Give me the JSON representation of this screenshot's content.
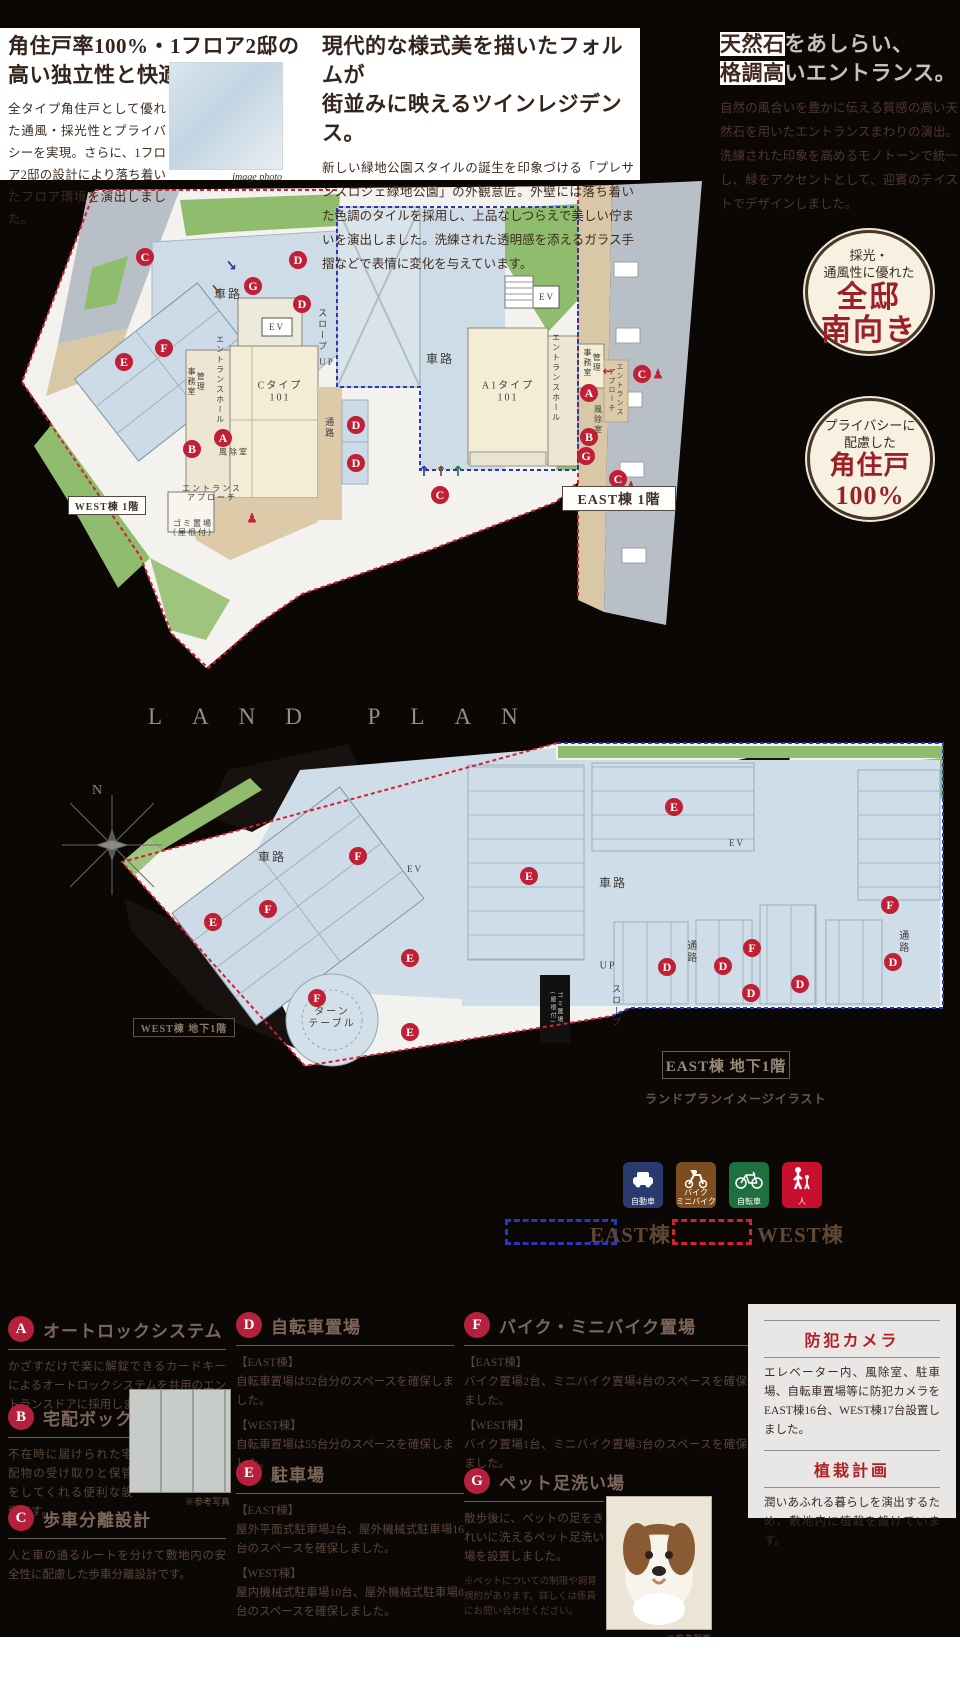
{
  "header": {
    "col1": {
      "title_lines": [
        "角住戸率100%・1フロア2邸の",
        "高い独立性と快適性。"
      ],
      "body": "全タイプ角住戸として優れた通風・採光性とプライバシーを実現。さらに、1フロア2邸の設計により落ち着いたフロア環境を演出しました。",
      "photo_caption": "image photo"
    },
    "col2": {
      "title_lines": [
        "現代的な様式美を描いたフォルムが",
        "街並みに映えるツインレジデンス。"
      ],
      "body": "新しい緑地公園スタイルの誕生を印象づける「プレサンスロジェ緑地公園」の外観意匠。外壁には落ち着いた色調のタイルを採用し、上品なしつらえで美しい佇まいを演出しました。洗練された透明感を添えるガラス手摺などで表情に変化を与えています。"
    },
    "col3": {
      "title1_dark": "天然石",
      "title1_light": "をあしらい、",
      "title2_dark": "格調高",
      "title2_light": "いエントランス。",
      "body": "自然の風合いを豊かに伝える質感の高い天然石を用いたエントランスまわりの演出。洗練された印象を高めるモノトーンで統一し、緑をアクセントとして、迎賓のテイストでデザインしました。"
    }
  },
  "badges": [
    {
      "small1": "採光・",
      "small2": "通風性に優れた",
      "big1": "全邸",
      "big2": "南向き"
    },
    {
      "small1": "プライバシーに",
      "small2": "配慮した",
      "big1": "角住戸",
      "big2": "100%"
    }
  ],
  "land_plan_title": "LAND PLAN",
  "plan1": {
    "labels": [
      {
        "t": "車路",
        "x": 228,
        "y": 295,
        "s": 12
      },
      {
        "t": "車路",
        "x": 440,
        "y": 360,
        "s": 12
      },
      {
        "t": "スロープ",
        "x": 322,
        "y": 330,
        "s": 9,
        "v": true
      },
      {
        "t": "UP",
        "x": 327,
        "y": 362,
        "s": 9
      },
      {
        "t": "EV",
        "x": 277,
        "y": 327,
        "s": 9
      },
      {
        "t": "エントランスホール",
        "x": 220,
        "y": 380,
        "s": 8,
        "v": true
      },
      {
        "t": "管理\n事務室",
        "x": 196,
        "y": 382,
        "s": 8,
        "v": true
      },
      {
        "t": "Cタイプ\n101",
        "x": 280,
        "y": 392,
        "s": 10
      },
      {
        "t": "風除室",
        "x": 234,
        "y": 452,
        "s": 8
      },
      {
        "t": "エントランス\nアプローチ",
        "x": 212,
        "y": 493,
        "s": 8
      },
      {
        "t": "ゴミ置場\n（屋根付）",
        "x": 193,
        "y": 528,
        "s": 8
      },
      {
        "t": "通路",
        "x": 329,
        "y": 428,
        "s": 9,
        "v": true
      },
      {
        "t": "A1タイプ\n101",
        "x": 508,
        "y": 392,
        "s": 10
      },
      {
        "t": "エントランスホール",
        "x": 556,
        "y": 378,
        "s": 8,
        "v": true
      },
      {
        "t": "管理\n事務室",
        "x": 592,
        "y": 363,
        "s": 8,
        "v": true
      },
      {
        "t": "風除室",
        "x": 598,
        "y": 420,
        "s": 8,
        "v": true
      },
      {
        "t": "エントランス\nアプローチ",
        "x": 616,
        "y": 390,
        "s": 7,
        "v": true
      },
      {
        "t": "EV",
        "x": 547,
        "y": 297,
        "s": 9
      }
    ],
    "markers": [
      {
        "l": "C",
        "x": 145,
        "y": 257
      },
      {
        "l": "D",
        "x": 298,
        "y": 260
      },
      {
        "l": "G",
        "x": 253,
        "y": 286
      },
      {
        "l": "D",
        "x": 302,
        "y": 304
      },
      {
        "l": "F",
        "x": 164,
        "y": 348
      },
      {
        "l": "E",
        "x": 124,
        "y": 362
      },
      {
        "l": "A",
        "x": 223,
        "y": 438
      },
      {
        "l": "B",
        "x": 192,
        "y": 449
      },
      {
        "l": "D",
        "x": 356,
        "y": 425
      },
      {
        "l": "D",
        "x": 356,
        "y": 463
      },
      {
        "l": "A",
        "x": 589,
        "y": 393
      },
      {
        "l": "B",
        "x": 589,
        "y": 437
      },
      {
        "l": "G",
        "x": 586,
        "y": 456
      },
      {
        "l": "C",
        "x": 642,
        "y": 374
      },
      {
        "l": "C",
        "x": 618,
        "y": 479
      },
      {
        "l": "C",
        "x": 440,
        "y": 495
      }
    ],
    "glyphs": [
      {
        "ch": "↓",
        "color": "#2a3a9a",
        "x": 232,
        "y": 266,
        "rot": -40,
        "s": 14
      },
      {
        "ch": "↓",
        "color": "#7a4a1a",
        "x": 217,
        "y": 290,
        "rot": -40,
        "s": 14
      },
      {
        "ch": "↑",
        "color": "#2a3a9a",
        "x": 424,
        "y": 472,
        "rot": 0,
        "s": 14
      },
      {
        "ch": "↑",
        "color": "#7a4a1a",
        "x": 441,
        "y": 472,
        "rot": 0,
        "s": 14
      },
      {
        "ch": "↑",
        "color": "#1f7a35",
        "x": 458,
        "y": 472,
        "rot": 0,
        "s": 14
      },
      {
        "ch": "←",
        "color": "#c0243a",
        "x": 608,
        "y": 372,
        "rot": 0,
        "s": 13
      },
      {
        "ch": "♟",
        "color": "#c0243a",
        "x": 658,
        "y": 375,
        "rot": 0,
        "s": 13
      },
      {
        "ch": "♟",
        "color": "#c0243a",
        "x": 631,
        "y": 487,
        "rot": 0,
        "s": 13
      },
      {
        "ch": "♟",
        "color": "#c0243a",
        "x": 252,
        "y": 519,
        "rot": 0,
        "s": 13
      }
    ]
  },
  "plan2": {
    "compass": "N",
    "caption": "ランドプランイメージイラスト",
    "labels": [
      {
        "t": "車路",
        "x": 272,
        "y": 858,
        "s": 12
      },
      {
        "t": "車路",
        "x": 613,
        "y": 884,
        "s": 12
      },
      {
        "t": "ターン\nテーブル",
        "x": 332,
        "y": 1018,
        "s": 10
      },
      {
        "t": "UP",
        "x": 608,
        "y": 966,
        "s": 10
      },
      {
        "t": "EV",
        "x": 415,
        "y": 869,
        "s": 9
      },
      {
        "t": "EV",
        "x": 737,
        "y": 843,
        "s": 9
      },
      {
        "t": "通路",
        "x": 690,
        "y": 952,
        "s": 10,
        "v": true
      },
      {
        "t": "通路",
        "x": 902,
        "y": 942,
        "s": 10,
        "v": true
      },
      {
        "t": "スロープ",
        "x": 616,
        "y": 1006,
        "s": 9,
        "v": true
      },
      {
        "t": "ゴミ置場\n(屋根付)",
        "x": 555,
        "y": 1008,
        "s": 6,
        "v": true,
        "c": "#cfcac2"
      }
    ],
    "markers": [
      {
        "l": "E",
        "x": 213,
        "y": 922
      },
      {
        "l": "F",
        "x": 268,
        "y": 909
      },
      {
        "l": "F",
        "x": 358,
        "y": 856
      },
      {
        "l": "E",
        "x": 410,
        "y": 958
      },
      {
        "l": "E",
        "x": 410,
        "y": 1032
      },
      {
        "l": "F",
        "x": 317,
        "y": 998
      },
      {
        "l": "E",
        "x": 674,
        "y": 807
      },
      {
        "l": "E",
        "x": 529,
        "y": 876
      },
      {
        "l": "D",
        "x": 667,
        "y": 967
      },
      {
        "l": "D",
        "x": 723,
        "y": 966
      },
      {
        "l": "F",
        "x": 752,
        "y": 948
      },
      {
        "l": "D",
        "x": 751,
        "y": 993
      },
      {
        "l": "D",
        "x": 800,
        "y": 984
      },
      {
        "l": "F",
        "x": 890,
        "y": 905
      },
      {
        "l": "D",
        "x": 893,
        "y": 962
      }
    ]
  },
  "plan_boxes": [
    {
      "t": "WEST棟 1階",
      "x": 68,
      "y": 496,
      "w": 76,
      "h": 17,
      "s": 10,
      "bg": "#ffffff",
      "bd": "#55493e",
      "c": "#3f3227"
    },
    {
      "t": "EAST棟 1階",
      "x": 562,
      "y": 486,
      "w": 112,
      "h": 23,
      "s": 14,
      "bg": "#ffffff",
      "bd": "#55493e",
      "c": "#3f3227"
    },
    {
      "t": "WEST棟 地下1階",
      "x": 133,
      "y": 1018,
      "w": 100,
      "h": 17,
      "s": 10,
      "bg": "transparent",
      "bd": "#5e5146",
      "c": "#8a7a6a"
    },
    {
      "t": "EAST棟 地下1階",
      "x": 662,
      "y": 1051,
      "w": 126,
      "h": 26,
      "s": 15,
      "bg": "transparent",
      "bd": "#6d5d50",
      "c": "#9a8a78"
    }
  ],
  "vehicle_legend": [
    {
      "label": "自動車",
      "color": "#2b3a6e",
      "icon": "car"
    },
    {
      "label": "バイク\nミニバイク",
      "color": "#7d4d1d",
      "icon": "moped"
    },
    {
      "label": "自転車",
      "color": "#1f6f3f",
      "icon": "bicycle"
    },
    {
      "label": "人",
      "color": "#c8102e",
      "icon": "person"
    }
  ],
  "area_legend": [
    {
      "label": "EAST棟",
      "color": "#2b37b5"
    },
    {
      "label": "WEST棟",
      "color": "#cf2233"
    }
  ],
  "features": [
    {
      "letter": "A",
      "title": "オートロックシステム",
      "paras": [
        "かざすだけで楽に解錠できるカードキーによるオートロックシステムを共用のエントランスドアに採用しました。"
      ]
    },
    {
      "letter": "B",
      "title": "宅配ボックス",
      "paras": [
        "不在時に届けられた宅配物の受け取りと保管をしてくれる便利な設備です。"
      ],
      "photo_caption": "※参考写真"
    },
    {
      "letter": "C",
      "title": "歩車分離設計",
      "paras": [
        "人と車の通るルートを分けて敷地内の安全性に配慮した歩車分離設計です。"
      ]
    },
    {
      "letter": "D",
      "title": "自転車置場",
      "paras": [
        "【EAST棟】\n自転車置場は52台分のスペースを確保しました。",
        "【WEST棟】\n自転車置場は55台分のスペースを確保しました。"
      ]
    },
    {
      "letter": "E",
      "title": "駐車場",
      "paras": [
        "【EAST棟】\n屋外平面式駐車場2台、屋外機械式駐車場16台のスペースを確保しました。",
        "【WEST棟】\n屋内機械式駐車場10台、屋外機械式駐車場8台のスペースを確保しました。"
      ]
    },
    {
      "letter": "F",
      "title": "バイク・ミニバイク置場",
      "paras": [
        "【EAST棟】\nバイク置場2台、ミニバイク置場4台のスペースを確保しました。",
        "【WEST棟】\nバイク置場1台、ミニバイク置場3台のスペースを確保しました。"
      ]
    },
    {
      "letter": "G",
      "title": "ペット足洗い場",
      "paras": [
        "散歩後に、ペットの足をきれいに洗えるペット足洗い場を設置しました。"
      ],
      "note": "※ペットについての制限や飼育規約があります。詳しくは係員にお問い合わせください。",
      "photo_caption": "※参考写真"
    }
  ],
  "info_box": {
    "sections": [
      {
        "heading": "防犯カメラ",
        "body": "エレベーター内、風除室、駐車場、自転車置場等に防犯カメラをEAST棟16台、WEST棟17台設置しました。"
      },
      {
        "heading": "植栽計画",
        "body": "潤いあふれる暮らしを演出するため、敷地内に植栽を設けています。"
      }
    ]
  },
  "colors": {
    "accent_red": "#9c1f27",
    "marker_red": "#c01f35",
    "dash_red": "#cf2233",
    "dash_blue": "#2b37b5"
  }
}
